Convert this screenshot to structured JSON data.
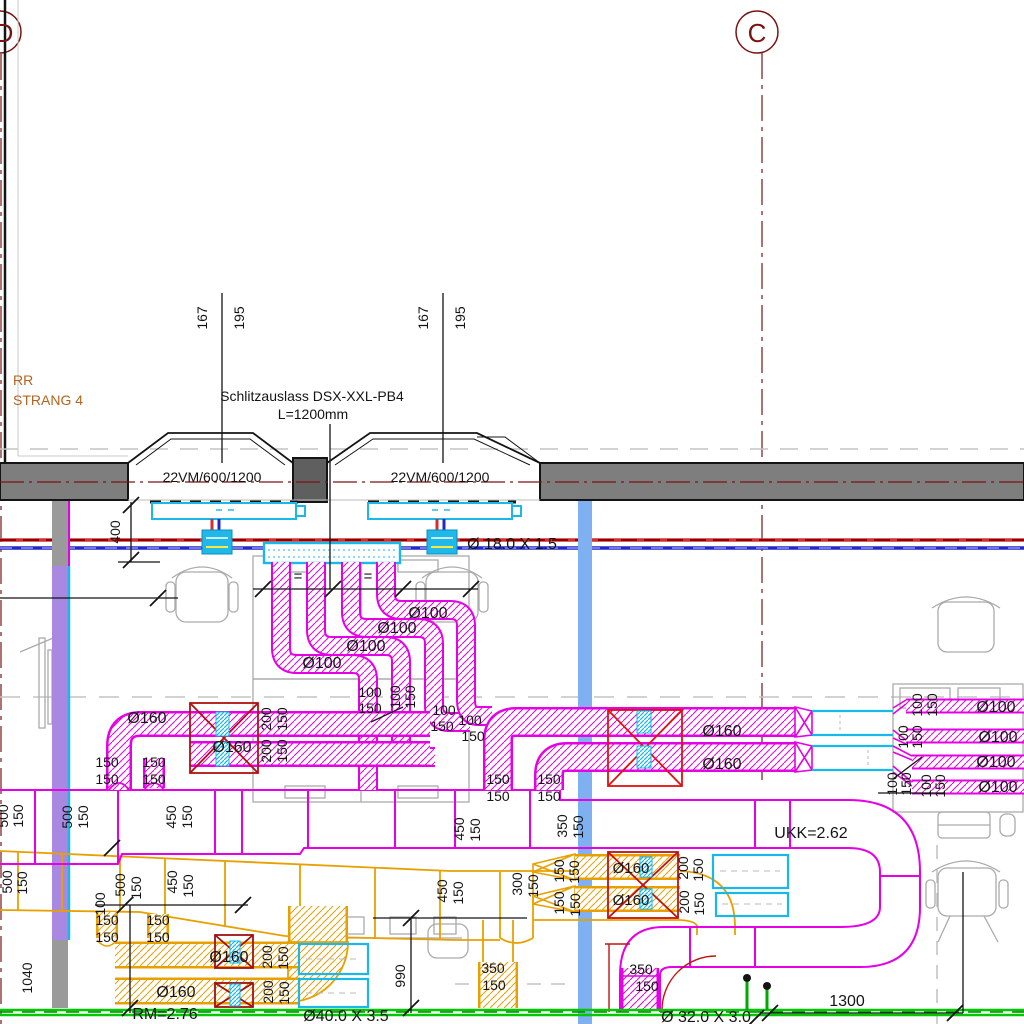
{
  "meta": {
    "drawing_type": "HVAC ventilation ceiling plan detail",
    "system_note": "RR STRANG 4 supply/exhaust duct layout with slot diffusers"
  },
  "colors": {
    "duct_magenta": "#E600E6",
    "duct_yellow": "#E8A000",
    "pipe_red": "#D03030",
    "pipe_blue": "#2428C8",
    "grid_dark_red": "#7A1414",
    "equipment_red": "#C01414",
    "cyan": "#18B8E8",
    "column_blue": "#7FB0F2",
    "column_lavender": "#A888E0",
    "wall_gray": "#7E7E7E",
    "green_line": "#00C800",
    "annotation_orange": "#B4641E",
    "dim_black": "#141414"
  },
  "grid_bubbles": [
    {
      "label": "D",
      "cx": 0,
      "cy": 32
    },
    {
      "label": "C",
      "cx": 757,
      "cy": 32
    }
  ],
  "labels": [
    {
      "t": "D",
      "x": 4,
      "y": 42,
      "s": 26,
      "c": "#7A1414"
    },
    {
      "t": "C",
      "x": 757,
      "y": 42,
      "s": 26,
      "c": "#7A1414"
    },
    {
      "t": "167",
      "x": 207,
      "y": 318,
      "r": -90
    },
    {
      "t": "195",
      "x": 244,
      "y": 318,
      "r": -90
    },
    {
      "t": "167",
      "x": 428,
      "y": 318,
      "r": -90
    },
    {
      "t": "195",
      "x": 465,
      "y": 318,
      "r": -90
    },
    {
      "t": "Schlitzauslass DSX-XXL-PB4",
      "x": 312,
      "y": 401
    },
    {
      "t": "L=1200mm",
      "x": 313,
      "y": 419
    },
    {
      "t": "RR",
      "x": 13,
      "y": 385,
      "c": "#B4641E",
      "a": "start"
    },
    {
      "t": "STRANG 4",
      "x": 13,
      "y": 405,
      "c": "#B4641E",
      "a": "start"
    },
    {
      "t": "22VM/600/1200",
      "x": 212,
      "y": 482
    },
    {
      "t": "22VM/600/1200",
      "x": 440,
      "y": 482
    },
    {
      "t": "400",
      "x": 120,
      "y": 532,
      "r": -90
    },
    {
      "t": "Ø 18.0 X 1.5",
      "x": 512,
      "y": 549,
      "s": 16
    },
    {
      "t": "Ø100",
      "x": 428,
      "y": 618,
      "s": 16
    },
    {
      "t": "Ø100",
      "x": 397,
      "y": 633,
      "s": 16
    },
    {
      "t": "Ø100",
      "x": 366,
      "y": 651,
      "s": 16
    },
    {
      "t": "Ø100",
      "x": 322,
      "y": 668,
      "s": 16
    },
    {
      "t": "100",
      "x": 370,
      "y": 697
    },
    {
      "t": "150",
      "x": 370,
      "y": 713
    },
    {
      "t": "100",
      "x": 400,
      "y": 697,
      "r": -90
    },
    {
      "t": "150",
      "x": 415,
      "y": 697,
      "r": -90
    },
    {
      "t": "100",
      "x": 444,
      "y": 715
    },
    {
      "t": "150",
      "x": 442,
      "y": 731
    },
    {
      "t": "100",
      "x": 470,
      "y": 725
    },
    {
      "t": "150",
      "x": 473,
      "y": 741
    },
    {
      "t": "Ø160",
      "x": 147,
      "y": 723,
      "s": 16
    },
    {
      "t": "Ø160",
      "x": 232,
      "y": 752,
      "s": 16
    },
    {
      "t": "200",
      "x": 271,
      "y": 719,
      "r": -90
    },
    {
      "t": "150",
      "x": 287,
      "y": 719,
      "r": -90
    },
    {
      "t": "200",
      "x": 271,
      "y": 751,
      "r": -90
    },
    {
      "t": "150",
      "x": 287,
      "y": 751,
      "r": -90
    },
    {
      "t": "150",
      "x": 107,
      "y": 767
    },
    {
      "t": "150",
      "x": 107,
      "y": 784
    },
    {
      "t": "150",
      "x": 154,
      "y": 767
    },
    {
      "t": "150",
      "x": 154,
      "y": 784
    },
    {
      "t": "150",
      "x": 498,
      "y": 784
    },
    {
      "t": "150",
      "x": 498,
      "y": 801
    },
    {
      "t": "150",
      "x": 549,
      "y": 784
    },
    {
      "t": "150",
      "x": 549,
      "y": 801
    },
    {
      "t": "Ø160",
      "x": 722,
      "y": 736,
      "s": 16
    },
    {
      "t": "Ø160",
      "x": 722,
      "y": 769,
      "s": 16
    },
    {
      "t": "Ø100",
      "x": 996,
      "y": 712,
      "s": 16
    },
    {
      "t": "Ø100",
      "x": 998,
      "y": 742,
      "s": 16
    },
    {
      "t": "Ø100",
      "x": 996,
      "y": 767,
      "s": 16
    },
    {
      "t": "Ø100",
      "x": 998,
      "y": 792,
      "s": 16
    },
    {
      "t": "100",
      "x": 922,
      "y": 705,
      "r": -90
    },
    {
      "t": "150",
      "x": 937,
      "y": 705,
      "r": -90
    },
    {
      "t": "100",
      "x": 908,
      "y": 737,
      "r": -90
    },
    {
      "t": "150",
      "x": 922,
      "y": 737,
      "r": -90
    },
    {
      "t": "100",
      "x": 897,
      "y": 784,
      "r": -90
    },
    {
      "t": "150",
      "x": 911,
      "y": 784,
      "r": -90
    },
    {
      "t": "100",
      "x": 931,
      "y": 786,
      "r": -90
    },
    {
      "t": "150",
      "x": 945,
      "y": 786,
      "r": -90
    },
    {
      "t": "UKK=2.62",
      "x": 811,
      "y": 838,
      "s": 16
    },
    {
      "t": "500",
      "x": 8,
      "y": 816,
      "r": -90
    },
    {
      "t": "150",
      "x": 23,
      "y": 816,
      "r": -90
    },
    {
      "t": "500",
      "x": 72,
      "y": 817,
      "r": -90
    },
    {
      "t": "150",
      "x": 88,
      "y": 817,
      "r": -90
    },
    {
      "t": "450",
      "x": 176,
      "y": 817,
      "r": -90
    },
    {
      "t": "150",
      "x": 192,
      "y": 817,
      "r": -90
    },
    {
      "t": "450",
      "x": 464,
      "y": 829,
      "r": -90
    },
    {
      "t": "150",
      "x": 480,
      "y": 830,
      "r": -90
    },
    {
      "t": "350",
      "x": 567,
      "y": 826,
      "r": -90
    },
    {
      "t": "150",
      "x": 583,
      "y": 827,
      "r": -90
    },
    {
      "t": "500",
      "x": 12,
      "y": 882,
      "r": -90
    },
    {
      "t": "150",
      "x": 27,
      "y": 883,
      "r": -90
    },
    {
      "t": "100",
      "x": 105,
      "y": 904,
      "r": -90
    },
    {
      "t": "500",
      "x": 125,
      "y": 885,
      "r": -90
    },
    {
      "t": "150",
      "x": 141,
      "y": 888,
      "r": -90
    },
    {
      "t": "450",
      "x": 177,
      "y": 882,
      "r": -90
    },
    {
      "t": "150",
      "x": 193,
      "y": 886,
      "r": -90
    },
    {
      "t": "150",
      "x": 107,
      "y": 925
    },
    {
      "t": "150",
      "x": 107,
      "y": 942
    },
    {
      "t": "150",
      "x": 158,
      "y": 925
    },
    {
      "t": "150",
      "x": 158,
      "y": 942
    },
    {
      "t": "1040",
      "x": 32,
      "y": 978,
      "r": -90
    },
    {
      "t": "Ø160",
      "x": 229,
      "y": 962,
      "s": 16
    },
    {
      "t": "Ø160",
      "x": 176,
      "y": 997,
      "s": 16
    },
    {
      "t": "200",
      "x": 272,
      "y": 957,
      "r": -90
    },
    {
      "t": "150",
      "x": 288,
      "y": 958,
      "r": -90
    },
    {
      "t": "200",
      "x": 273,
      "y": 992,
      "r": -90
    },
    {
      "t": "150",
      "x": 289,
      "y": 993,
      "r": -90
    },
    {
      "t": "450",
      "x": 447,
      "y": 891,
      "r": -90
    },
    {
      "t": "150",
      "x": 463,
      "y": 893,
      "r": -90
    },
    {
      "t": "300",
      "x": 522,
      "y": 884,
      "r": -90
    },
    {
      "t": "150",
      "x": 538,
      "y": 886,
      "r": -90
    },
    {
      "t": "150",
      "x": 564,
      "y": 871,
      "r": -90
    },
    {
      "t": "150",
      "x": 579,
      "y": 872,
      "r": -90
    },
    {
      "t": "150",
      "x": 564,
      "y": 903,
      "r": -90
    },
    {
      "t": "150",
      "x": 580,
      "y": 905,
      "r": -90
    },
    {
      "t": "Ø160",
      "x": 631,
      "y": 873,
      "s": 15
    },
    {
      "t": "Ø160",
      "x": 631,
      "y": 905,
      "s": 15
    },
    {
      "t": "200",
      "x": 688,
      "y": 868,
      "r": -90
    },
    {
      "t": "150",
      "x": 703,
      "y": 870,
      "r": -90
    },
    {
      "t": "200",
      "x": 689,
      "y": 902,
      "r": -90
    },
    {
      "t": "150",
      "x": 704,
      "y": 904,
      "r": -90
    },
    {
      "t": "350",
      "x": 493,
      "y": 973
    },
    {
      "t": "150",
      "x": 494,
      "y": 990
    },
    {
      "t": "990",
      "x": 405,
      "y": 976,
      "r": -90
    },
    {
      "t": "350",
      "x": 641,
      "y": 974
    },
    {
      "t": "150",
      "x": 647,
      "y": 991
    },
    {
      "t": "RM=2.76",
      "x": 165,
      "y": 1019,
      "s": 16
    },
    {
      "t": "Ø40.0 X 3.5",
      "x": 346,
      "y": 1021,
      "s": 16
    },
    {
      "t": "Ø 32.0 X 3.0",
      "x": 706,
      "y": 1022,
      "s": 16
    },
    {
      "t": "1300",
      "x": 847,
      "y": 1006,
      "s": 16
    },
    {
      "t": "=",
      "x": 298,
      "y": 581,
      "s": 15
    },
    {
      "t": "=",
      "x": 368,
      "y": 581,
      "s": 15
    }
  ]
}
